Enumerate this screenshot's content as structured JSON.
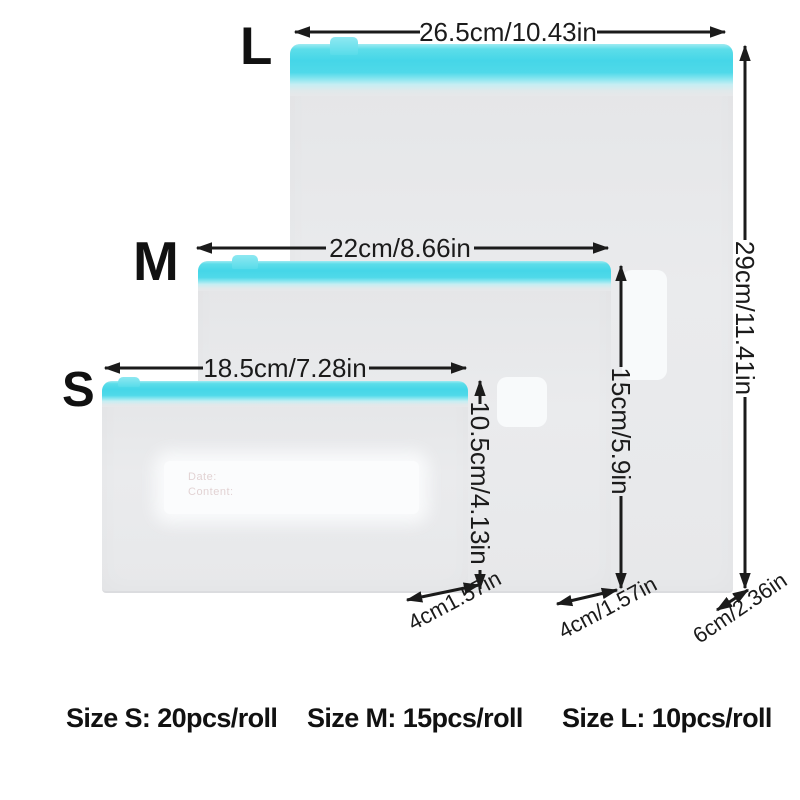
{
  "sizes": [
    {
      "letter": "L",
      "width_label": "26.5cm/10.43in",
      "height_label": "29cm/11.41in",
      "gusset_label": "6cm/2.36in"
    },
    {
      "letter": "M",
      "width_label": "22cm/8.66in",
      "height_label": "15cm/5.9in",
      "gusset_label": "4cm/1.57in"
    },
    {
      "letter": "S",
      "width_label": "18.5cm/7.28in",
      "height_label": "10.5cm/4.13in",
      "gusset_label": "4cm1.57in"
    }
  ],
  "footer": {
    "size_s": "Size S: 20pcs/roll",
    "size_m": "Size M: 15pcs/roll",
    "size_l": "Size L: 10pcs/roll"
  },
  "bag_print": {
    "date_label": "Date:",
    "content_label": "Content:"
  },
  "colors": {
    "zipper": "#45d6e8",
    "zipper_light": "#9febf2",
    "bag": "#e7e8ea",
    "label": "#f8fafb",
    "arrow": "#1b1b1b",
    "ink": "#111111",
    "background": "#ffffff"
  }
}
